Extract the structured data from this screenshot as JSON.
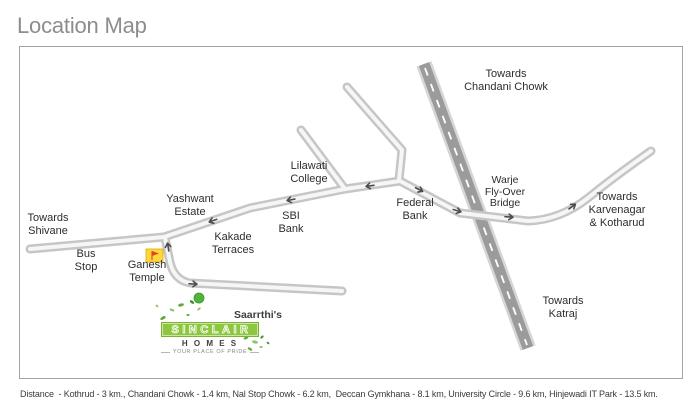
{
  "title": "Location Map",
  "map": {
    "labels": {
      "towards_chandani_chowk": [
        "Towards",
        "Chandani Chowk"
      ],
      "towards_shivane": [
        "Towards",
        "Shivane"
      ],
      "bus_stop": [
        "Bus",
        "Stop"
      ],
      "ganesh_temple": [
        "Ganesh",
        "Temple"
      ],
      "yashwant_estate": [
        "Yashwant",
        "Estate"
      ],
      "kakade_terraces": [
        "Kakade",
        "Terraces"
      ],
      "sbi_bank": [
        "SBI",
        "Bank"
      ],
      "lilawati_college": [
        "Lilawati",
        "College"
      ],
      "federal_bank": [
        "Federal",
        "Bank"
      ],
      "warje_flyover_bridge": [
        "Warje",
        "Fly-Over",
        "Bridge"
      ],
      "towards_karvenagar": [
        "Towards",
        "Karvenagar",
        "& Kotharud"
      ],
      "towards_katraj": [
        "Towards",
        "Katraj"
      ]
    },
    "icons": {
      "ganesh_temple_marker": "temple-flag-icon",
      "project_location_marker": "green-dot-icon",
      "road_direction": "direction-arrow-icon"
    }
  },
  "logo": {
    "prefix": "Saarrthi's",
    "name": "SINCLAIR",
    "sub": "H O M E S",
    "tagline": "YOUR PLACE OF PRIDE"
  },
  "footer": {
    "distances": "Distance  - Kothrud - 3 km., Chandani Chowk - 1.4 km, Nal Stop Chowk - 6.2 km,  Deccan Gymkhana - 8.1 km, University Circle - 9.6 km, Hinjewadi IT Park - 13.5 km."
  },
  "colors": {
    "brand_green": "#8dc63f",
    "dot_green": "#4fb53a",
    "temple_yellow": "#ffd83e",
    "flag_red": "#e8431f",
    "road_gray": "#c6c6c6",
    "highway_gray": "#9b9b9b",
    "title_gray": "#8d8d8d"
  }
}
